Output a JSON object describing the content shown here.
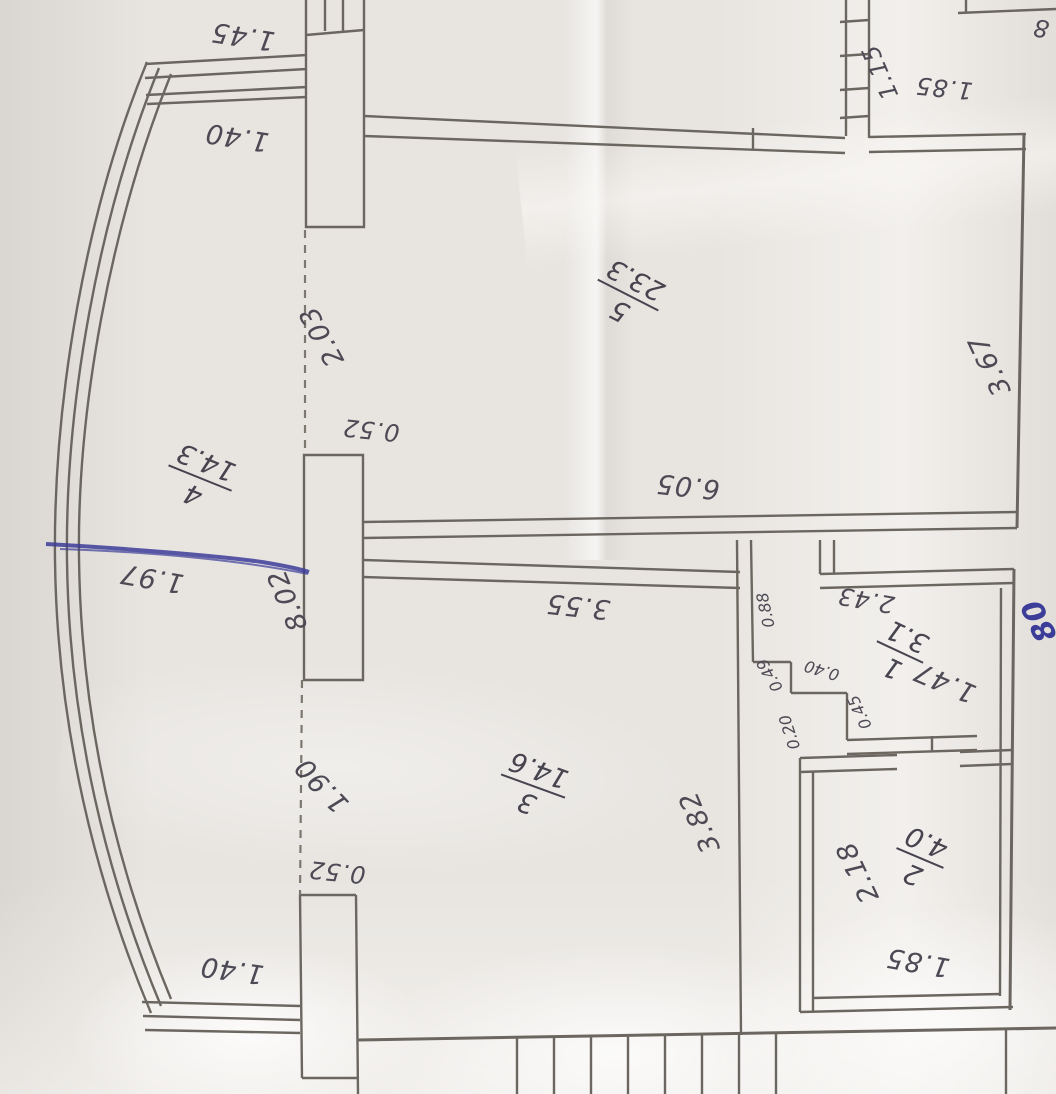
{
  "plan": {
    "kind": "scanned floor plan photo, drawing rotated 180 degrees",
    "rooms": {
      "r1": {
        "number": "1",
        "area": "3.1"
      },
      "r2": {
        "number": "2",
        "area": "4.0"
      },
      "r3": {
        "number": "3",
        "area": "14.6"
      },
      "r4": {
        "number": "4",
        "area": "14.3"
      },
      "r5": {
        "number": "5",
        "area": "23.3"
      }
    },
    "labels": {
      "top_1_45": "1.45",
      "top_1_40": "1.40",
      "dash_2_03": "2.03",
      "pier_0_52_top": "0.52",
      "room5_3_67": "3.67",
      "dash_8_02": "8.02",
      "balcony_1_97": "1.97",
      "wall_6_05": "6.05",
      "room3_3_55": "3.55",
      "niche_0_88": "0.88",
      "room1_2_43": "2.43",
      "niche_0_49": "0.49",
      "niche_0_40": "0.40",
      "niche_0_20": "0.20",
      "niche_0_45": "0.45",
      "room1_1_47": "1.47",
      "dash_1_90": "1.90",
      "room3_3_82": "3.82",
      "room2_2_18": "2.18",
      "room2_1_85": "1.85",
      "bottom_1_40": "1.40",
      "bottom_0_52": "0.52",
      "topright_1_15": "1.15",
      "topright_1_85": "1.85",
      "topright_partial_8": "8",
      "pen_note_80": "80"
    },
    "colors": {
      "paper": "#e8e5e1",
      "pencil": "#6b665f",
      "text": "#4e4a55",
      "pen_blue": "#3c3d99"
    }
  }
}
